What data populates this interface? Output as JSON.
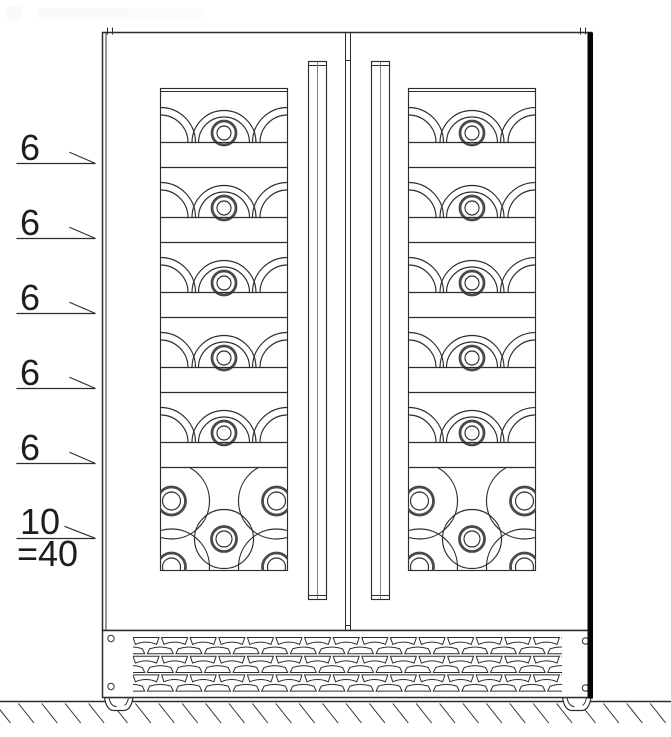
{
  "diagram": {
    "type": "technical-line-drawing",
    "subject": "double-door wine cooler front elevation with bottle capacity callouts"
  },
  "callouts": {
    "shelf_rows": [
      {
        "label": "6"
      },
      {
        "label": "6"
      },
      {
        "label": "6"
      },
      {
        "label": "6"
      },
      {
        "label": "6"
      }
    ],
    "bottom_compartment": {
      "label": "10"
    },
    "total": {
      "label": "=40"
    }
  },
  "structure": {
    "doors": 2,
    "shelf_rows_per_door": 5,
    "bottles_shown_per_shelf": 3,
    "bottom_bottles_shown_per_door": 5,
    "grille_rows": 6,
    "grille_columns": 16,
    "feet": 2,
    "screws": 4
  },
  "colors": {
    "line": "#2d2d2d",
    "shadow": "#050505",
    "ring": "#4a4a4a",
    "background": "#ffffff"
  }
}
